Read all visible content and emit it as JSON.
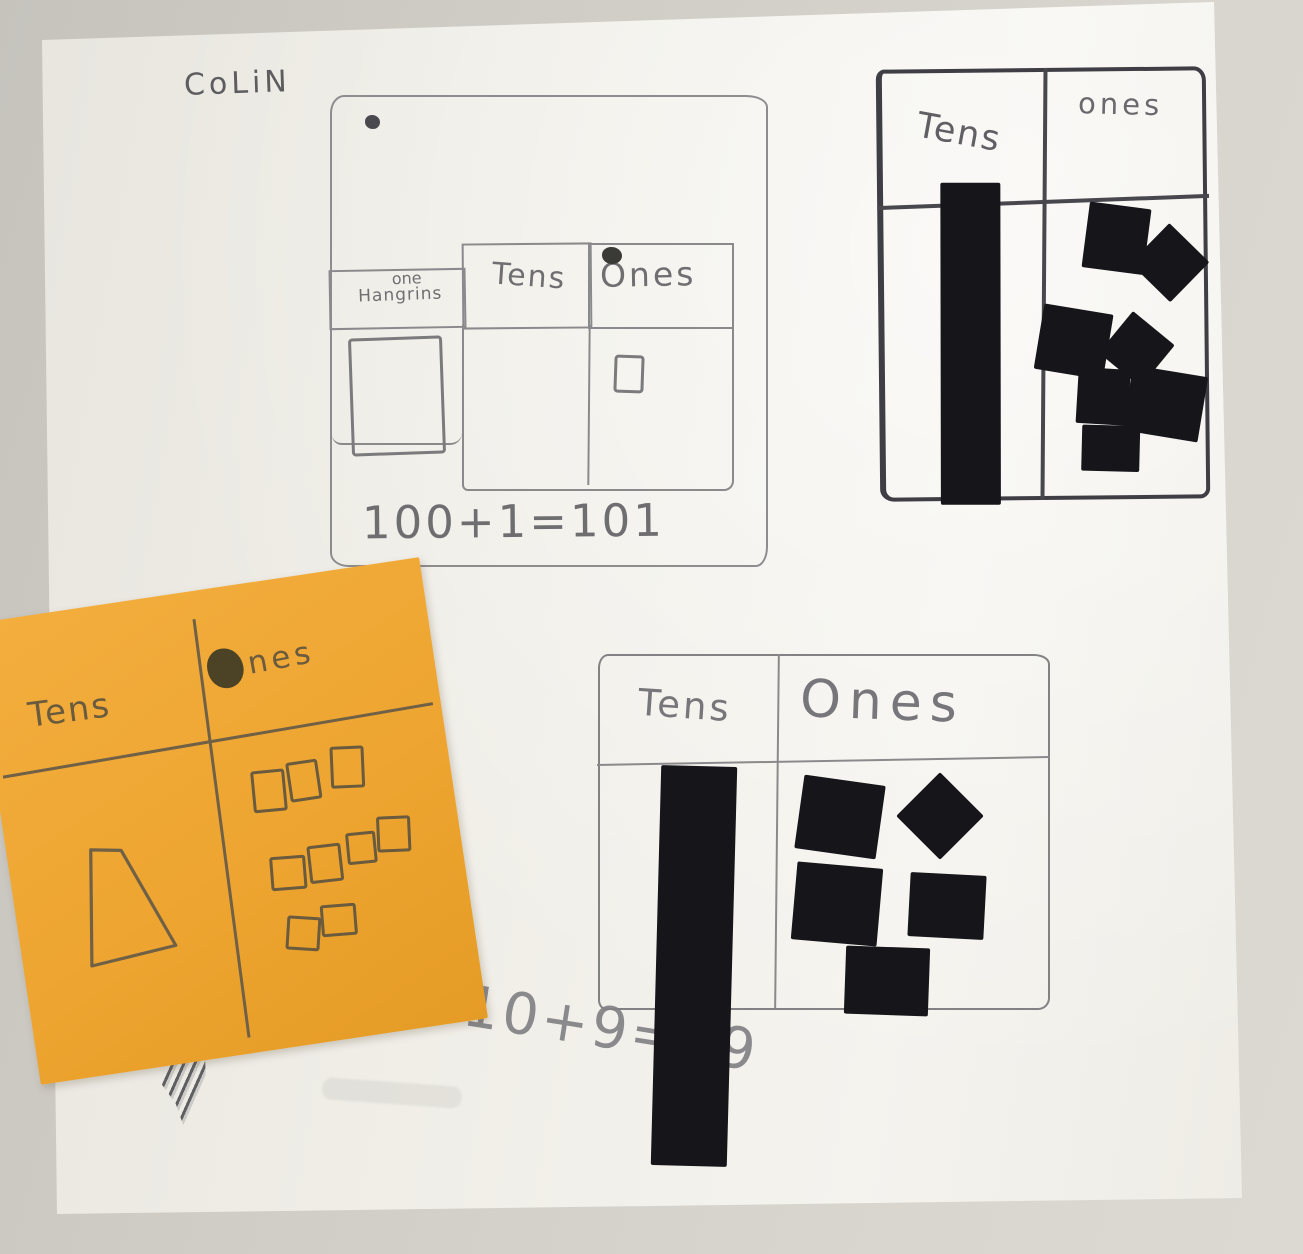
{
  "photo": {
    "student_name": "CoLiN",
    "background_color": "#cfccc5",
    "paper_color": "#f2f0ea",
    "pencil_color": "#7a7a7c",
    "marker_color": "#3e3e44",
    "tile_color": "#15151a",
    "sticky_note_color": "#efa636",
    "sticky_note_ink_color": "#6a5b3e"
  },
  "hundreds_chart": {
    "header_col1_line1": "one",
    "header_col1_line2": "Hangrins",
    "tens_label": "Tens",
    "ones_label": "Ones",
    "equation": "100+1=101",
    "hundreds_flat_count": 1,
    "tens_count": 0,
    "ones_count": 1,
    "hundreds_flats": [
      {
        "x": 18,
        "y": 240,
        "w": 88,
        "h": 112,
        "r": -2
      }
    ],
    "ones_squares": [
      {
        "x": 282,
        "y": 258,
        "w": 24,
        "h": 32,
        "r": 2
      }
    ]
  },
  "top_right_chart": {
    "tens_label": "Tens",
    "ones_label": "ones",
    "tens_rod_count": 1,
    "ones_square_count": 7,
    "tens_rods": [
      {
        "x": 56,
        "y": 110,
        "w": 60,
        "h": 322,
        "r": 0.5
      }
    ],
    "ones_squares": [
      {
        "x": 202,
        "y": 134,
        "w": 62,
        "h": 66,
        "r": 8
      },
      {
        "x": 258,
        "y": 164,
        "w": 56,
        "h": 56,
        "r": 45
      },
      {
        "x": 154,
        "y": 237,
        "w": 70,
        "h": 66,
        "r": 10
      },
      {
        "x": 225,
        "y": 251,
        "w": 54,
        "h": 54,
        "r": 40
      },
      {
        "x": 192,
        "y": 297,
        "w": 52,
        "h": 56,
        "r": 4
      },
      {
        "x": 242,
        "y": 300,
        "w": 76,
        "h": 66,
        "r": 10
      },
      {
        "x": 196,
        "y": 354,
        "w": 58,
        "h": 46,
        "r": 2
      }
    ]
  },
  "bottom_chart": {
    "tens_label": "Tens",
    "ones_label": "Ones",
    "equation": "10+9=19",
    "tens_rod_count": 1,
    "ones_square_count": 5,
    "tens_rods": [
      {
        "x": 56,
        "y": 110,
        "w": 76,
        "h": 400,
        "r": 1.5
      }
    ],
    "ones_squares": [
      {
        "x": 199,
        "y": 124,
        "w": 82,
        "h": 74,
        "r": 8
      },
      {
        "x": 309,
        "y": 129,
        "w": 62,
        "h": 62,
        "r": 45
      },
      {
        "x": 194,
        "y": 209,
        "w": 86,
        "h": 78,
        "r": 5
      },
      {
        "x": 309,
        "y": 218,
        "w": 76,
        "h": 64,
        "r": 3
      },
      {
        "x": 245,
        "y": 291,
        "w": 84,
        "h": 68,
        "r": 2
      }
    ]
  },
  "sticky_note": {
    "tens_label": "Tens",
    "ones_label": "Ones",
    "ones_label_suffix": "nes",
    "tens_shape_count": 1,
    "ones_rows": [
      3,
      4,
      2
    ],
    "ones_total": 9,
    "ones_outline_squares": [
      {
        "x": 252,
        "y": 188,
        "w": 28,
        "h": 36,
        "r": 3
      },
      {
        "x": 289,
        "y": 184,
        "w": 26,
        "h": 34,
        "r": 0
      },
      {
        "x": 333,
        "y": 176,
        "w": 28,
        "h": 36,
        "r": 6
      },
      {
        "x": 258,
        "y": 276,
        "w": 30,
        "h": 28,
        "r": 4
      },
      {
        "x": 297,
        "y": 270,
        "w": 28,
        "h": 32,
        "r": 2
      },
      {
        "x": 337,
        "y": 263,
        "w": 24,
        "h": 26,
        "r": 3
      },
      {
        "x": 369,
        "y": 252,
        "w": 28,
        "h": 30,
        "r": 6
      },
      {
        "x": 265,
        "y": 338,
        "w": 28,
        "h": 28,
        "r": 12
      },
      {
        "x": 301,
        "y": 331,
        "w": 30,
        "h": 26,
        "r": 4
      }
    ]
  }
}
